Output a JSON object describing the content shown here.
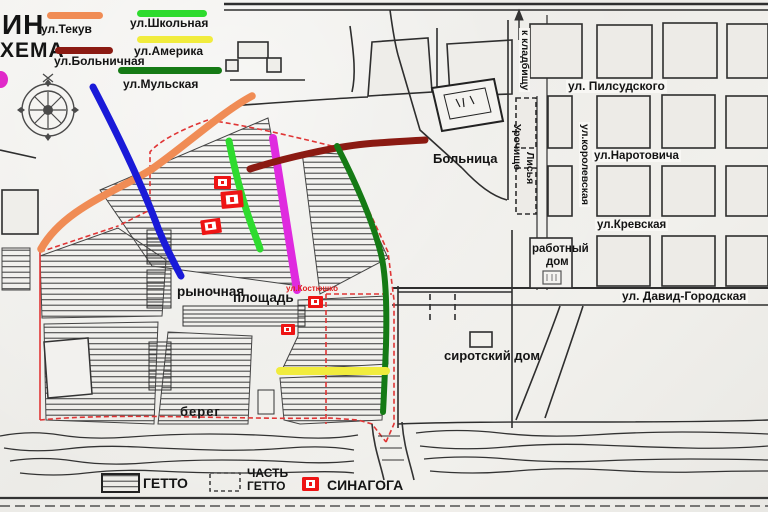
{
  "title": {
    "line1": "ИН",
    "line2": "ХЕМА"
  },
  "colors": {
    "tekuv_orange": "#f08c55",
    "shkolnaya_green": "#2edb2e",
    "bolnichnaya_darkred": "#8b1a12",
    "amerika_yellow": "#f1ec3d",
    "mulskaya_darkgreen": "#157a15",
    "blue_street": "#1a1ad8",
    "magenta_street": "#df2adf",
    "ghetto_boundary_red": "#e03535",
    "synagogue_red": "#ee1414",
    "pink_marker": "#e029c9"
  },
  "legend_top": {
    "items": [
      {
        "label": "ул.Текув"
      },
      {
        "label": "ул.Школьная"
      },
      {
        "label": "ул.Больничная"
      },
      {
        "label": "ул.Америка"
      },
      {
        "label": "ул.Мульская"
      }
    ]
  },
  "legend_bottom": {
    "ghetto": "ГЕТТО",
    "part_ghetto_line1": "ЧАСТЬ",
    "part_ghetto_line2": "ГЕТТО",
    "synagogue": "СИНАГОГА"
  },
  "map_labels": {
    "cemetery": "к кладбищу",
    "pilsudskogo": "ул. Пилсудского",
    "urochishche": "Урочище",
    "lisya": "Лисья",
    "korolevskaya": "ул.королевская",
    "narotovicha": "ул.Наротовича",
    "krevskaya": "ул.Кревская",
    "rabotny_dom_line1": "работный",
    "rabotny_dom_line2": "дом",
    "david_gorodskaya": "ул. Давид-Городская",
    "sirotsky_dom": "сиротский дом",
    "bolnitsa": "Больница",
    "rynochnaya": "рыночная",
    "ploshchad": "площадь",
    "kostyushko": "ул.Костюшко",
    "bereg": "берег"
  }
}
